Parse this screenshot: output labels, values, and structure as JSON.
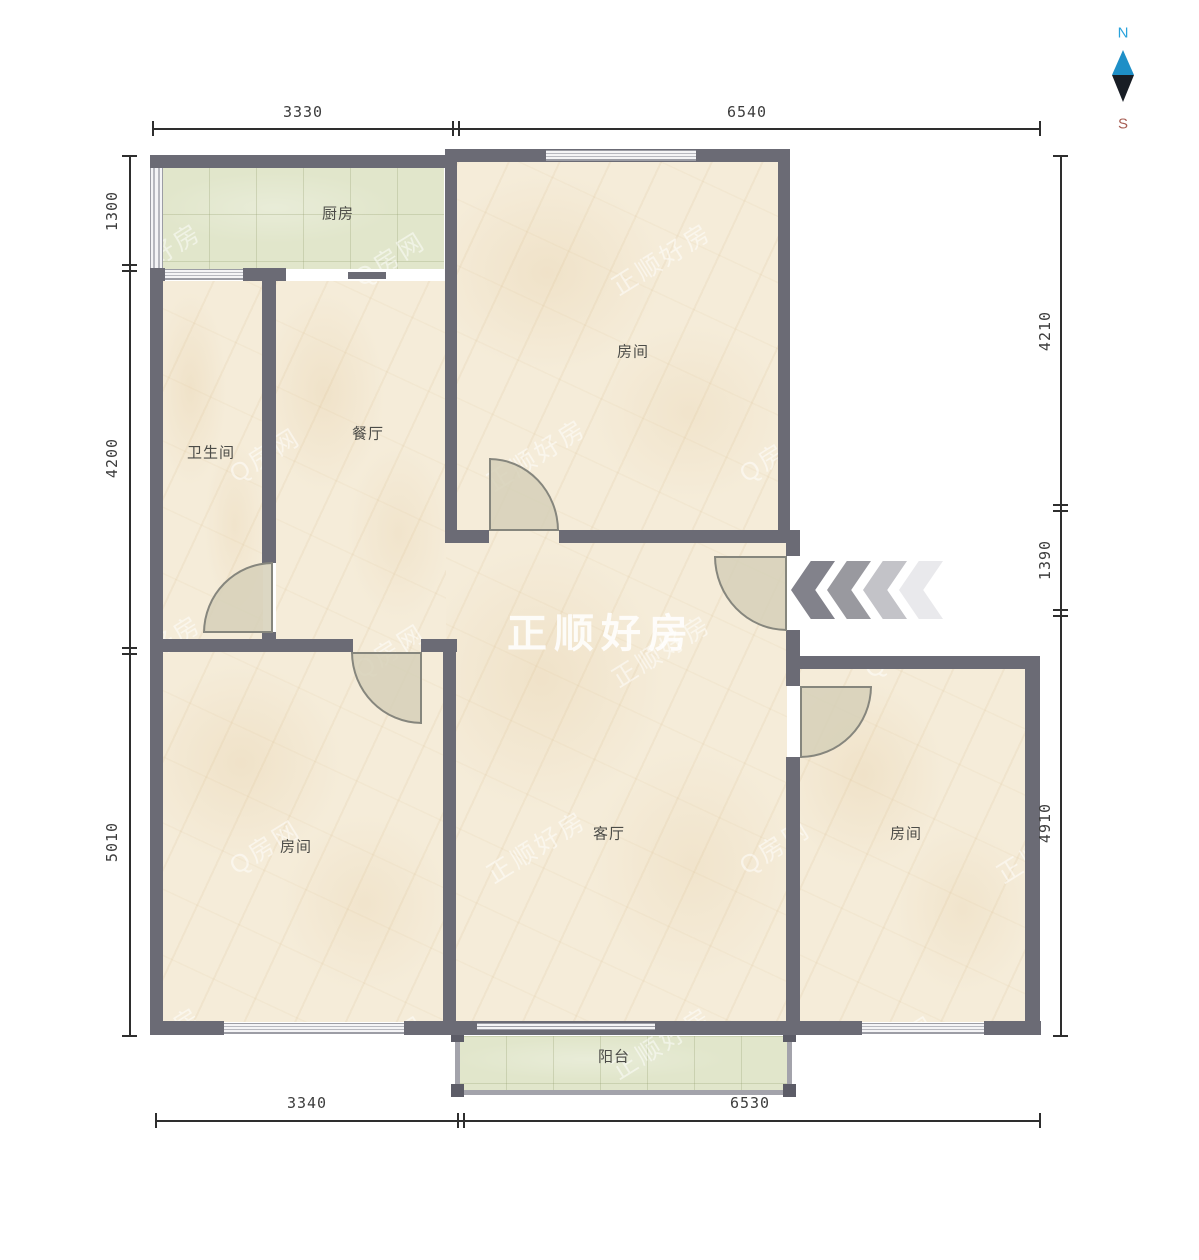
{
  "compass": {
    "north": "N",
    "south": "S"
  },
  "watermark": {
    "center": "正顺好房",
    "tiles": [
      "正顺好房",
      "Q房网"
    ]
  },
  "rooms": {
    "kitchen": "厨房",
    "bedroom_top": "房间",
    "bathroom": "卫生间",
    "dining": "餐厅",
    "living": "客厅",
    "bedroom_left": "房间",
    "bedroom_right": "房间",
    "balcony": "阳台"
  },
  "dimensions": {
    "top": [
      "3330",
      "6540"
    ],
    "bottom": [
      "3340",
      "6530"
    ],
    "left": [
      "1300",
      "4200",
      "5010"
    ],
    "right": [
      "4210",
      "1390",
      "4910"
    ]
  },
  "colors": {
    "wall": "#6b6b75",
    "floor": "#f5ecd9",
    "tile": "#e1e6cb",
    "dimension_text": "#3c3c3c",
    "north": "#29a3dc",
    "south": "#a85f55",
    "chevrons": [
      "#82828b",
      "#99999f",
      "#c3c3c8",
      "#e9e9ec"
    ]
  }
}
